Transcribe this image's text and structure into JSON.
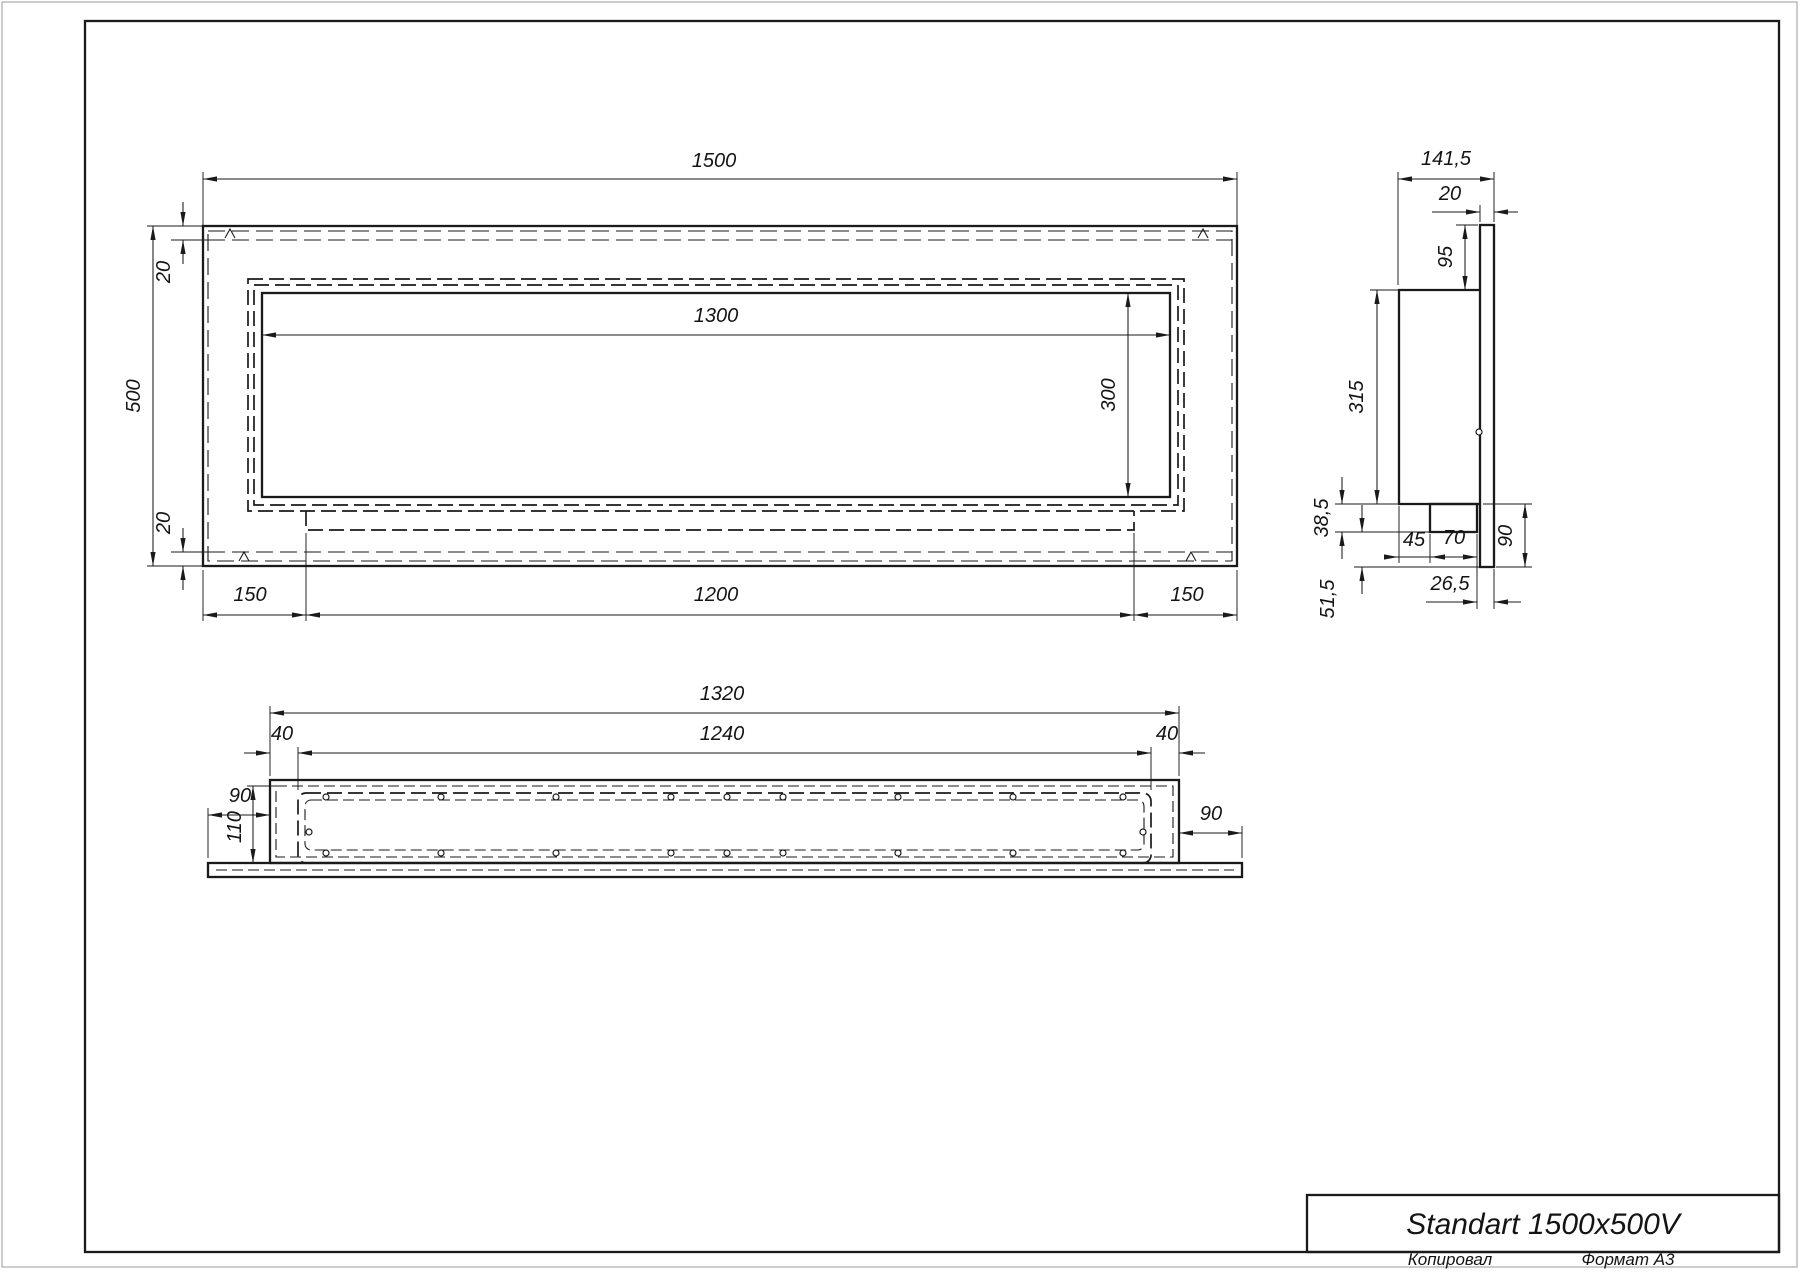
{
  "front_view": {
    "overall_width": "1500",
    "overall_height": "500",
    "flange_top": "20",
    "flange_bottom": "20",
    "opening_width": "1300",
    "opening_height": "300",
    "offset_left": "150",
    "tray_width": "1200",
    "offset_right": "150"
  },
  "side_view": {
    "overall_depth": "141,5",
    "front_plate_thickness": "20",
    "top_inset": "95",
    "body_height": "315",
    "tray_drop": "38,5",
    "tray_offset_back": "45",
    "tray_depth": "70",
    "plate_extension": "90",
    "tray_to_front": "26,5",
    "tray_bottom_to_plate": "51,5"
  },
  "bottom_view": {
    "body_width": "1320",
    "cavity_width": "1240",
    "inset_left": "40",
    "inset_right": "40",
    "flange_overhang_left": "90",
    "flange_overhang_right": "90",
    "cavity_depth": "110"
  },
  "title_block": {
    "title": "Standart 1500x500V",
    "copied_by": "Копировал",
    "format": "Формат А3"
  }
}
